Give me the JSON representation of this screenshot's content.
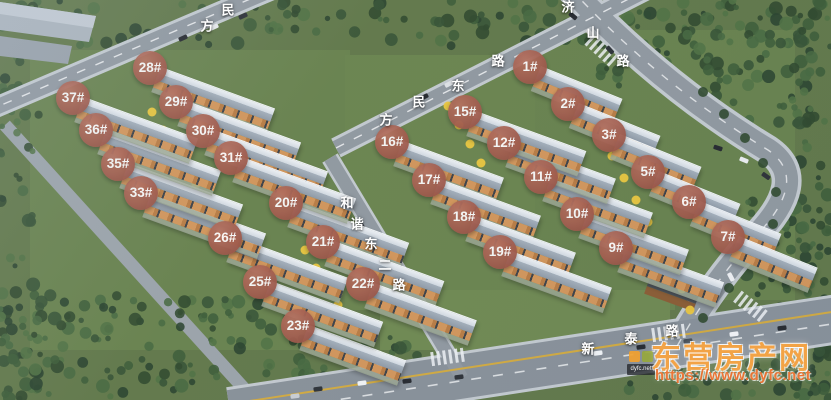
{
  "scene_name": "residential-complex-aerial-rendering",
  "badge_style": {
    "background": "#a05747",
    "text_color": "#ffffff"
  },
  "buildings": [
    {
      "label": "1#",
      "x": 530,
      "y": 67,
      "len": 88,
      "rot": 22
    },
    {
      "label": "2#",
      "x": 568,
      "y": 104,
      "len": 88,
      "rot": 22
    },
    {
      "label": "3#",
      "x": 609,
      "y": 135,
      "len": 88,
      "rot": 22
    },
    {
      "label": "5#",
      "x": 648,
      "y": 172,
      "len": 88,
      "rot": 22
    },
    {
      "label": "6#",
      "x": 689,
      "y": 202,
      "len": 88,
      "rot": 22
    },
    {
      "label": "7#",
      "x": 728,
      "y": 237,
      "len": 85,
      "rot": 22
    },
    {
      "label": "9#",
      "x": 616,
      "y": 248,
      "len": 104,
      "rot": 20
    },
    {
      "label": "10#",
      "x": 577,
      "y": 214,
      "len": 108,
      "rot": 20
    },
    {
      "label": "11#",
      "x": 541,
      "y": 177,
      "len": 108,
      "rot": 20
    },
    {
      "label": "12#",
      "x": 504,
      "y": 143,
      "len": 108,
      "rot": 20
    },
    {
      "label": "15#",
      "x": 465,
      "y": 112,
      "len": 118,
      "rot": 20
    },
    {
      "label": "16#",
      "x": 392,
      "y": 142,
      "len": 108,
      "rot": 20
    },
    {
      "label": "17#",
      "x": 429,
      "y": 180,
      "len": 108,
      "rot": 20
    },
    {
      "label": "18#",
      "x": 464,
      "y": 217,
      "len": 108,
      "rot": 20
    },
    {
      "label": "19#",
      "x": 500,
      "y": 252,
      "len": 108,
      "rot": 20
    },
    {
      "label": "20#",
      "x": 286,
      "y": 203,
      "len": 120,
      "rot": 20
    },
    {
      "label": "21#",
      "x": 323,
      "y": 242,
      "len": 118,
      "rot": 20
    },
    {
      "label": "22#",
      "x": 363,
      "y": 284,
      "len": 110,
      "rot": 20
    },
    {
      "label": "23#",
      "x": 298,
      "y": 326,
      "len": 104,
      "rot": 20
    },
    {
      "label": "25#",
      "x": 260,
      "y": 282,
      "len": 120,
      "rot": 20
    },
    {
      "label": "26#",
      "x": 225,
      "y": 238,
      "len": 120,
      "rot": 20
    },
    {
      "label": "28#",
      "x": 150,
      "y": 68,
      "len": 122,
      "rot": 20
    },
    {
      "label": "29#",
      "x": 176,
      "y": 102,
      "len": 122,
      "rot": 20
    },
    {
      "label": "30#",
      "x": 203,
      "y": 131,
      "len": 122,
      "rot": 20
    },
    {
      "label": "31#",
      "x": 231,
      "y": 158,
      "len": 122,
      "rot": 20
    },
    {
      "label": "33#",
      "x": 141,
      "y": 193,
      "len": 122,
      "rot": 20
    },
    {
      "label": "35#",
      "x": 118,
      "y": 164,
      "len": 122,
      "rot": 20
    },
    {
      "label": "36#",
      "x": 96,
      "y": 130,
      "len": 122,
      "rot": 20
    },
    {
      "label": "37#",
      "x": 73,
      "y": 98,
      "len": 122,
      "rot": 20
    }
  ],
  "road_labels": [
    {
      "name": "fangmin-east-road-upper",
      "chars": [
        {
          "ch": "方",
          "x": 207,
          "y": 25
        },
        {
          "ch": "民",
          "x": 228,
          "y": 9
        }
      ]
    },
    {
      "name": "fangmin-east-road",
      "chars": [
        {
          "ch": "方",
          "x": 386,
          "y": 119
        },
        {
          "ch": "民",
          "x": 419,
          "y": 101
        },
        {
          "ch": "东",
          "x": 458,
          "y": 85
        },
        {
          "ch": "路",
          "x": 498,
          "y": 60
        }
      ]
    },
    {
      "name": "jishan-road",
      "chars": [
        {
          "ch": "济",
          "x": 568,
          "y": 6
        },
        {
          "ch": "山",
          "x": 593,
          "y": 32
        },
        {
          "ch": "路",
          "x": 623,
          "y": 60
        }
      ]
    },
    {
      "name": "hexie-east-2nd-road",
      "chars": [
        {
          "ch": "和",
          "x": 347,
          "y": 202
        },
        {
          "ch": "谐",
          "x": 357,
          "y": 223
        },
        {
          "ch": "东",
          "x": 371,
          "y": 243
        },
        {
          "ch": "二",
          "x": 385,
          "y": 264
        },
        {
          "ch": "路",
          "x": 399,
          "y": 284
        }
      ]
    },
    {
      "name": "xintai-road",
      "chars": [
        {
          "ch": "新",
          "x": 588,
          "y": 348
        },
        {
          "ch": "泰",
          "x": 631,
          "y": 338
        },
        {
          "ch": "路",
          "x": 672,
          "y": 330
        }
      ]
    }
  ],
  "watermark": {
    "site_name": "东营房产网",
    "url": "https://www.dyfc.net",
    "logo_text": "dyfc.net",
    "accent_color": "#f09a2c"
  }
}
